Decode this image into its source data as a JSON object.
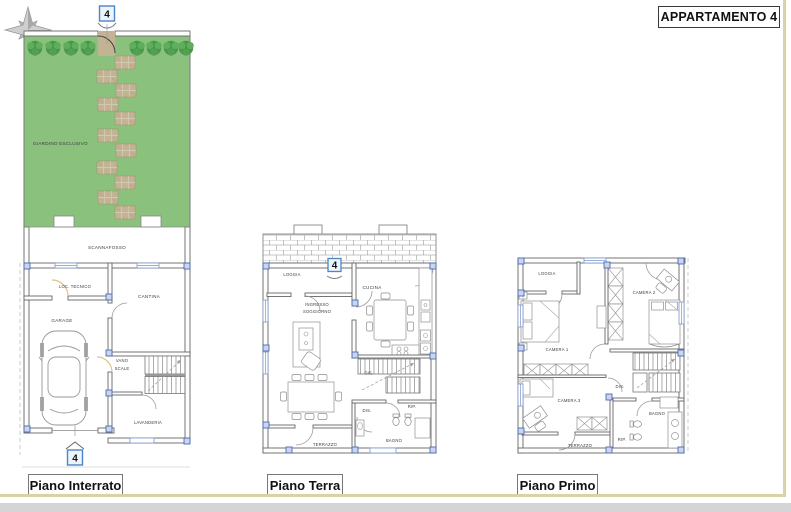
{
  "page": {
    "title": "APPARTAMENTO 4"
  },
  "compass": {
    "north_label": "N"
  },
  "unit_marker": "4",
  "colors": {
    "garden_green": "#8ac17c",
    "tree_green_dark": "#47984a",
    "tree_green_light": "#5fae5c",
    "stone_tan": "#c1b394",
    "marker_blue": "#4a86c8",
    "column_blue": "#c9d6ef",
    "frame_khaki": "#d8d2a4",
    "bottom_strip_gray": "#d5d5d5"
  },
  "floors": {
    "interrato": {
      "name": "Piano Interrato",
      "rooms": {
        "giardino": "GIARDINO ESCLUSIVO",
        "scannafosso": "SCANNAFOSSO",
        "loc_tecnico": "LOC. TECNICO",
        "cantina": "CANTINA",
        "garage": "GARAGE",
        "vano_line1": "VANO",
        "vano_line2": "SCALE",
        "lavanderia": "LAVANDERIA"
      }
    },
    "terra": {
      "name": "Piano Terra",
      "rooms": {
        "loggia": "LOGGIA",
        "ingresso_line1": "INGRESSO",
        "ingresso_line2": "SOGGIORNO",
        "cucina": "CUCINA",
        "dis1": "DIS.",
        "dis2": "DIS.",
        "rip": "RIP.",
        "bagno": "BAGNO",
        "terrazzo": "TERRAZZO"
      }
    },
    "primo": {
      "name": "Piano Primo",
      "rooms": {
        "loggia": "LOGGIA",
        "camera1": "CAMERA 1",
        "camera2": "CAMERA 2",
        "camera3": "CAMERA 3",
        "dis": "DIS.",
        "bagno": "BAGNO",
        "rip": "RIP.",
        "terrazzo": "TERRAZZO"
      }
    }
  }
}
